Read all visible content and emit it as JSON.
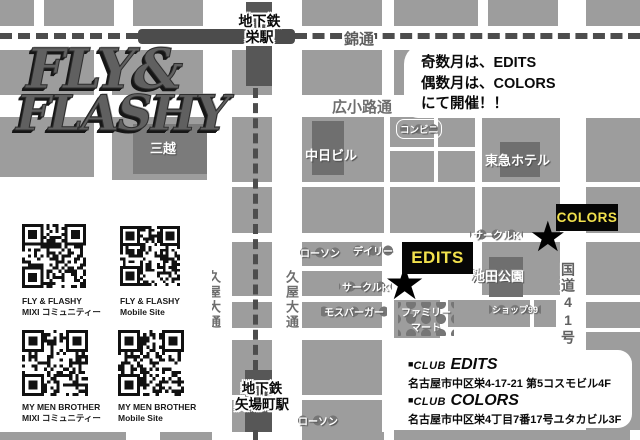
{
  "logo": {
    "line1": "FLY&",
    "line2": "FLASHY"
  },
  "notice": {
    "line1": "奇数月は、EDITS",
    "line2": "偶数月は、COLORS",
    "line3": "にて開催！！"
  },
  "stations": {
    "sakae_line1": "地下鉄",
    "sakae_line2": "栄駅",
    "yabacho_line1": "地下鉄",
    "yabacho_line2": "矢場町駅"
  },
  "roads": {
    "nishiki": "錦通",
    "hirokoji": "広小路通",
    "hisaya": "久屋大通",
    "route41": "国道41号"
  },
  "buildings": {
    "mitsukoshi": "三越",
    "chunichi": "中日ビル",
    "tokyu": "東急ホテル",
    "ikeda_park": "池田公園"
  },
  "stores": {
    "conbini": "コンビニ",
    "lawson_sakae": "ローソン",
    "daily": "デイリー",
    "circlek_edits": "サークルK",
    "circlek_ikeda": "サークルK",
    "mos_burger": "モスバーガー",
    "famima_line1": "ファミリー",
    "famima_line2": "マート",
    "shop99": "ショップ99",
    "lawson_yaba": "ローソン"
  },
  "venues": {
    "edits": "EDITS",
    "colors": "COLORS"
  },
  "qr_panel": {
    "items": [
      {
        "line1": "FLY & FLASHY",
        "line2": "MIXI コミュニティー"
      },
      {
        "line1": "FLY & FLASHY",
        "line2": "Mobile Site"
      },
      {
        "line1": "MY MEN BROTHER",
        "line2": "MIXI コミュニティー"
      },
      {
        "line1": "MY MEN BROTHER",
        "line2": "Mobile Site"
      }
    ]
  },
  "info": {
    "entries": [
      {
        "bullet": "■",
        "club": "CLUB",
        "name": "EDITS",
        "address": "名古屋市中区栄4-17-21 第5コスモビル4F"
      },
      {
        "bullet": "■",
        "club": "CLUB",
        "name": "COLORS",
        "address": "名古屋市中区栄4丁目7番17号ユタカビル3F"
      }
    ]
  },
  "colors": {
    "city_block": "#9d9d9d",
    "dark_building": "#6f6f6f",
    "subway": "#4c4c4c",
    "venue_bg": "#060606",
    "venue_text": "#f2e14d"
  }
}
